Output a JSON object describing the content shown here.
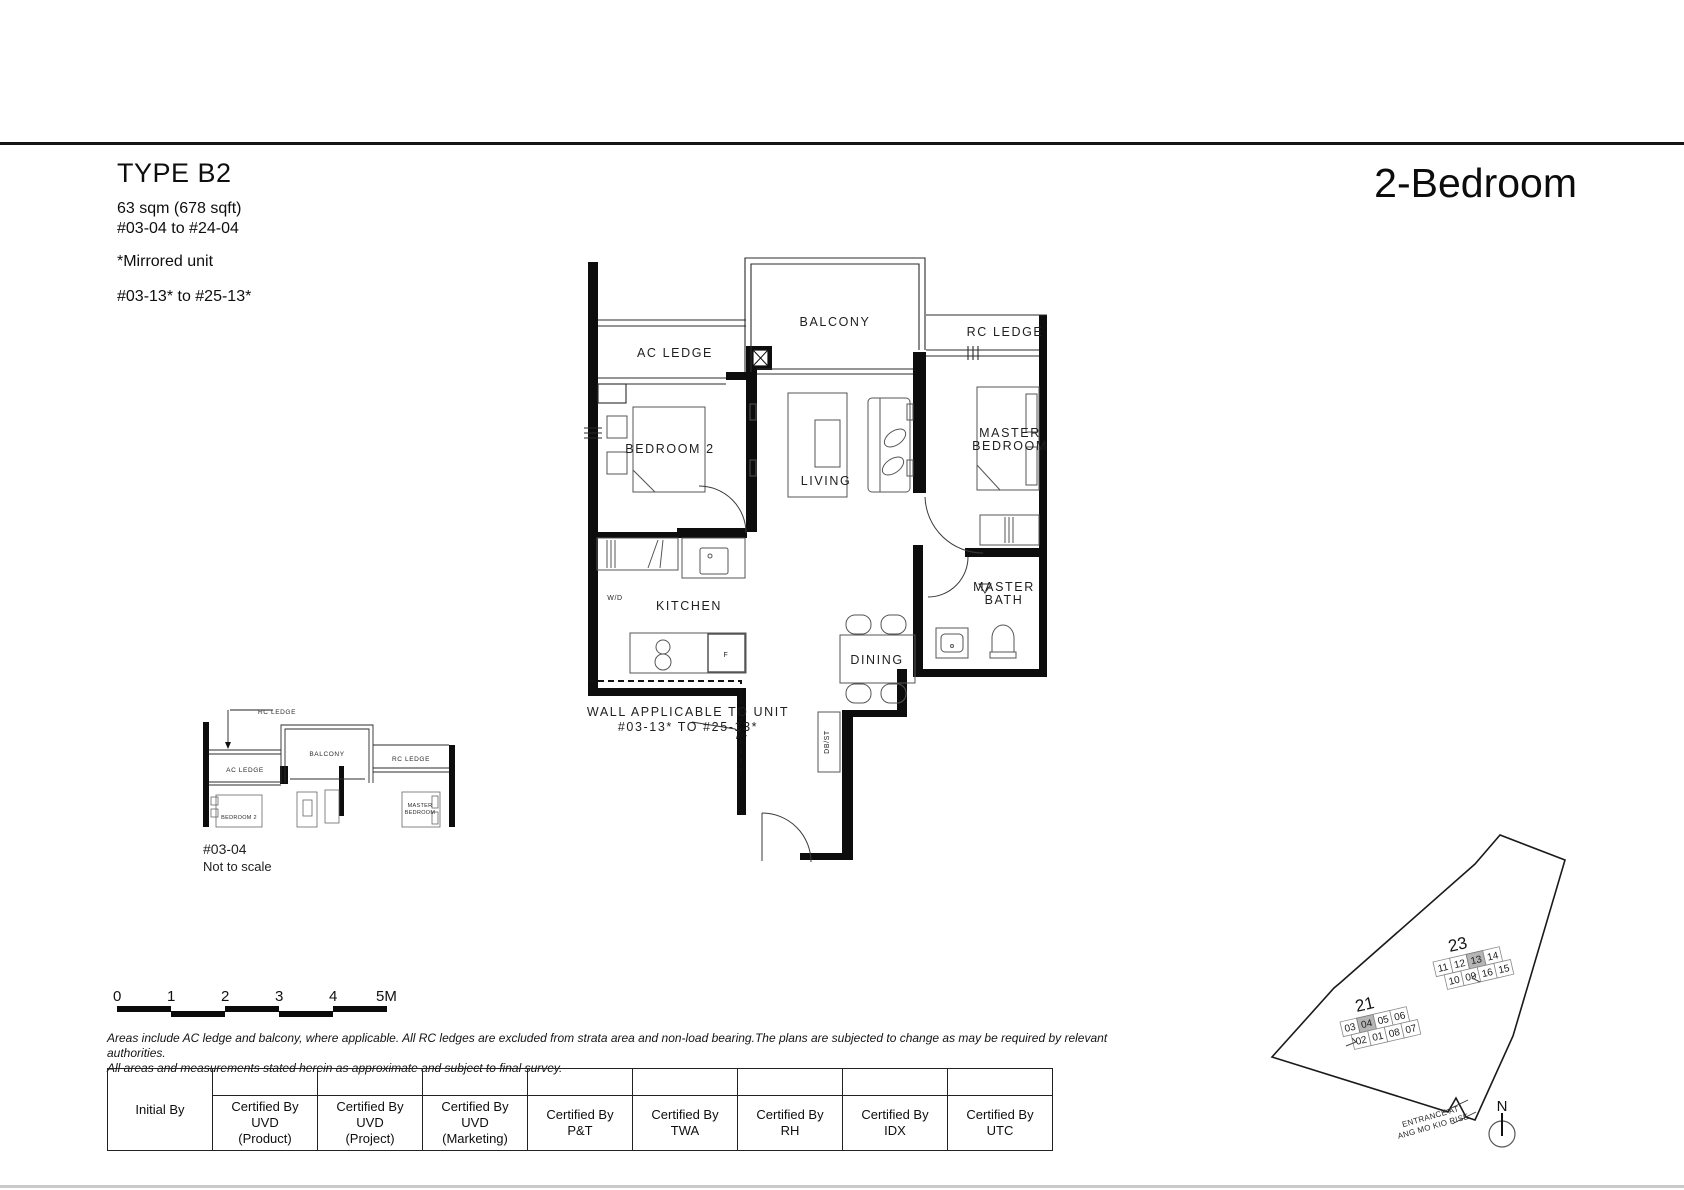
{
  "header": {
    "type_title": "TYPE B2",
    "area": "63 sqm (678 sqft)",
    "stack_range": "#03-04 to #24-04",
    "mirrored_note": "*Mirrored unit",
    "mirrored_range": "#03-13* to #25-13*",
    "category": "2-Bedroom"
  },
  "plan": {
    "labels": {
      "balcony": "BALCONY",
      "ac_ledge": "AC LEDGE",
      "rc_ledge": "RC LEDGE",
      "bedroom2": "BEDROOM 2",
      "living": "LIVING",
      "master_line1": "MASTER",
      "master_line2": "BEDROOM",
      "kitchen": "KITCHEN",
      "wd": "W/D",
      "fridge": "F",
      "bath_line1": "MASTER",
      "bath_line2": "BATH",
      "dining": "DINING",
      "dbst": "DB/ST"
    },
    "wall_note_line1": "WALL APPLICABLE TO UNIT",
    "wall_note_line2": "#03-13* TO #25-13*"
  },
  "mini_plan": {
    "callout": "RC LEDGE",
    "balcony": "BALCONY",
    "ac_ledge": "AC LEDGE",
    "rc_ledge": "RC LEDGE",
    "bedroom2": "BEDROOM 2",
    "master_line1": "MASTER",
    "master_line2": "BEDROOM",
    "unit_no": "#03-04",
    "note": "Not to scale"
  },
  "scale_bar": {
    "ticks": [
      "0",
      "1",
      "2",
      "3",
      "4",
      "5M"
    ]
  },
  "disclaimer": {
    "line1": "Areas include AC ledge and balcony, where applicable. All RC ledges are excluded from strata area and non-load bearing.The plans are subjected to change as may be required by relevant authorities.",
    "line2": "All areas and measurements stated herein as approximate and subject to final survey."
  },
  "table": {
    "initial_label": "Initial By",
    "columns": [
      {
        "lines": [
          "Certified By",
          "UVD",
          "(Product)"
        ]
      },
      {
        "lines": [
          "Certified By",
          "UVD",
          "(Project)"
        ]
      },
      {
        "lines": [
          "Certified By",
          "UVD",
          "(Marketing)"
        ]
      },
      {
        "lines": [
          "Certified By",
          "P&T"
        ]
      },
      {
        "lines": [
          "Certified By",
          "TWA"
        ]
      },
      {
        "lines": [
          "Certified By",
          "RH"
        ]
      },
      {
        "lines": [
          "Certified By",
          "IDX"
        ]
      },
      {
        "lines": [
          "Certified By",
          "UTC"
        ]
      }
    ]
  },
  "site_plan": {
    "block21": {
      "label": "21",
      "row1": [
        "03",
        "04",
        "05",
        "06"
      ],
      "row2": [
        "02",
        "01",
        "08",
        "07"
      ],
      "highlighted": "04"
    },
    "block23": {
      "label": "23",
      "row1": [
        "11",
        "12",
        "13",
        "14"
      ],
      "row2": [
        "10",
        "09",
        "16",
        "15"
      ],
      "highlighted": "13"
    },
    "entrance_line1": "ENTRANCE AT",
    "entrance_line2": "ANG MO KIO RISE",
    "north_label": "N",
    "highlight_color": "#b5b5b5"
  }
}
